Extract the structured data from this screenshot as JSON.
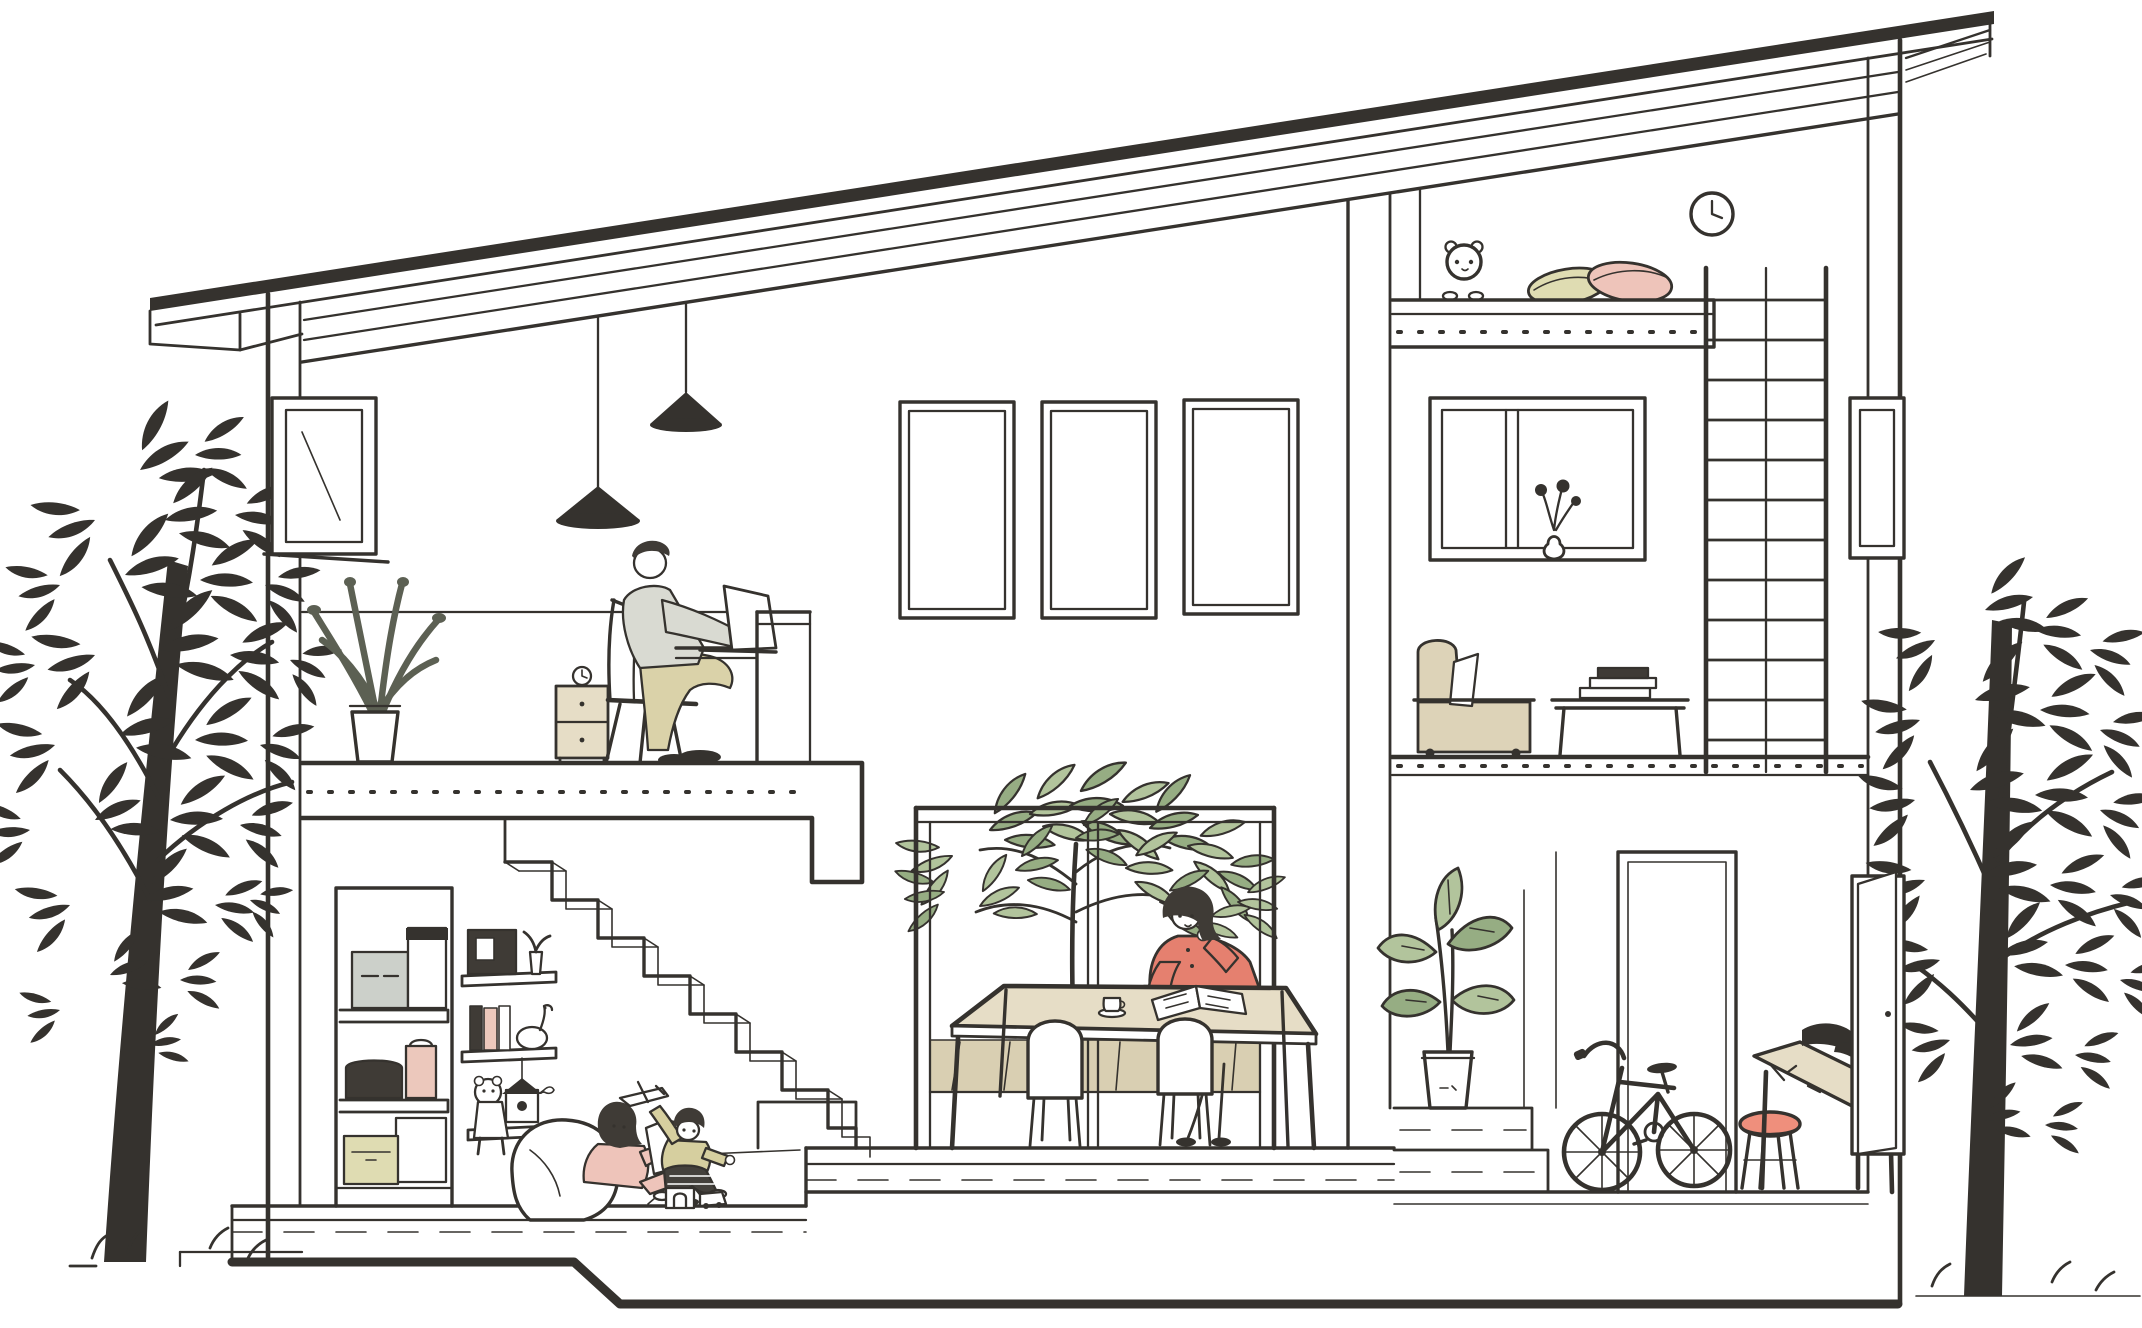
{
  "meta": {
    "title": "Cross-section illustration of a modern house with loft"
  },
  "colors": {
    "ink": "#35322e",
    "hair": "#3f3b36",
    "coral": "#e5806f",
    "coral_seat": "#ef8f7c",
    "pink": "#eec4ba",
    "pink_box": "#ecc8bc",
    "olive": "#dfdcb2",
    "olive_shirt": "#d6cf9f",
    "khaki": "#dad2a9",
    "sweater": "#d9dad2",
    "beige": "#e6ddc6",
    "wood": "#d9cfb2",
    "sofa": "#ddd3b8",
    "gray_box": "#ccd0ca",
    "dark_pants": "#44413c",
    "leaf": "#b2c49c",
    "leaf_dark": "#96ad83",
    "plant_dark": "#5c6053",
    "white": "#ffffff"
  },
  "scene": {
    "rooms": [
      {
        "id": "office",
        "label": "Home office mezzanine"
      },
      {
        "id": "living",
        "label": "Double-height living and dining room"
      },
      {
        "id": "play",
        "label": "Kids play area under the stairs"
      },
      {
        "id": "loft",
        "label": "Loft bedroom"
      },
      {
        "id": "sitting",
        "label": "Sitting room with sofa"
      },
      {
        "id": "entry",
        "label": "Entryway with bicycle and workbench"
      }
    ],
    "people": [
      {
        "id": "man",
        "label": "Man working on a laptop at a desk"
      },
      {
        "id": "woman",
        "label": "Woman in a coral cardigan reading at the dining table"
      },
      {
        "id": "girl",
        "label": "Girl in pink reading a book against a beanbag"
      },
      {
        "id": "boy",
        "label": "Boy in an olive shirt playing with a toy airplane"
      }
    ],
    "objects": [
      {
        "id": "left-tree",
        "label": "Ink-sketched tree at left"
      },
      {
        "id": "right-tree",
        "label": "Ink-sketched tree at right"
      },
      {
        "id": "roof",
        "label": "Mono-pitch roof with exposed rafters"
      },
      {
        "id": "pendant-lamps",
        "label": "Two black cone pendant lamps"
      },
      {
        "id": "office-plant",
        "label": "Tall potted plant in the office"
      },
      {
        "id": "side-table",
        "label": "Small beige side table with clock"
      },
      {
        "id": "laptop",
        "label": "Open laptop on desk"
      },
      {
        "id": "wall-windows",
        "label": "Three tall window frames on the living-room wall"
      },
      {
        "id": "big-window",
        "label": "Large picture window with a garden tree"
      },
      {
        "id": "dining-table",
        "label": "Wooden dining table with cup and open book"
      },
      {
        "id": "chairs",
        "label": "Two white dining chairs"
      },
      {
        "id": "staircase",
        "label": "Open staircase to the mezzanine"
      },
      {
        "id": "closet",
        "label": "Storage closet with boxes"
      },
      {
        "id": "wall-shelves",
        "label": "Wall shelves with radio, books, goose and birdhouse"
      },
      {
        "id": "beanbag",
        "label": "White beanbag"
      },
      {
        "id": "toys",
        "label": "Toy airplane, blocks and toy car"
      },
      {
        "id": "teddy-bear",
        "label": "Teddy bear peeking over the loft rail"
      },
      {
        "id": "pillows",
        "label": "Olive and pink pillows in the loft"
      },
      {
        "id": "wall-clock",
        "label": "Round wall clock"
      },
      {
        "id": "ladder",
        "label": "Tall ladder to the loft"
      },
      {
        "id": "sofa",
        "label": "Beige sofa with white cushion"
      },
      {
        "id": "coffee-table",
        "label": "Low table with stacked books"
      },
      {
        "id": "flower-vase",
        "label": "Round vase with flowers on the window sill"
      },
      {
        "id": "entry-plant",
        "label": "Potted plant on the entry step"
      },
      {
        "id": "bicycle",
        "label": "Black kids bicycle"
      },
      {
        "id": "stool",
        "label": "Stool with coral seat"
      },
      {
        "id": "workbench",
        "label": "Workbench with dark tools"
      },
      {
        "id": "doorway",
        "label": "Tall interior doorway"
      },
      {
        "id": "front-door",
        "label": "Front door ajar on the right wall"
      }
    ]
  }
}
